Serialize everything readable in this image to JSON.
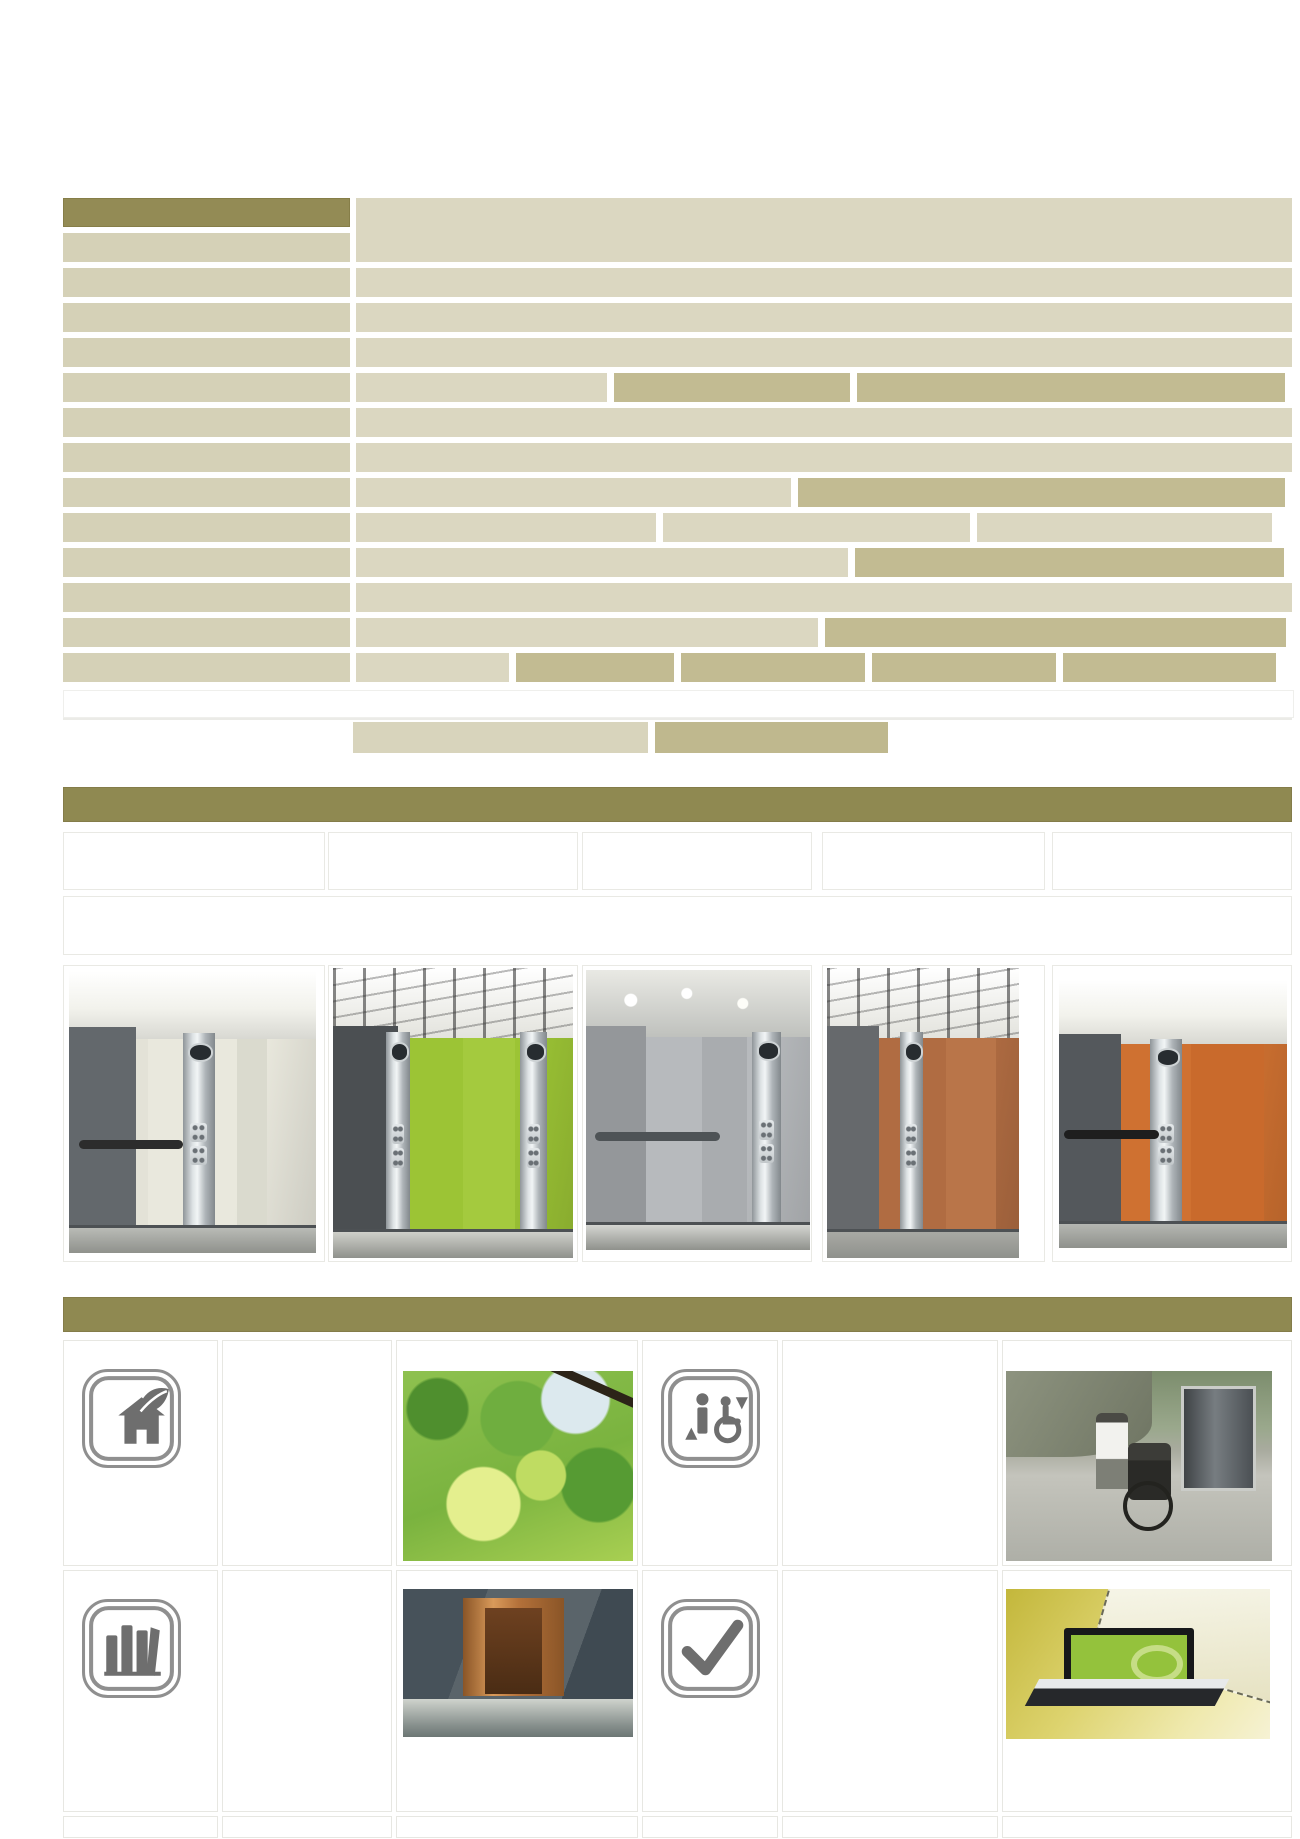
{
  "document": {
    "kind": "elevator brochure page",
    "visible_text": "",
    "note_all_cells_blank": true
  },
  "palette": {
    "olive_header": "#938b55",
    "olive_bar": "#8f8951",
    "beige_light": "#dbd7c1",
    "beige_label": "#d5d1b7",
    "khaki_dark": "#c2bb92",
    "footnote_light": "#d8d4bc",
    "footnote_dark": "#bfb88e",
    "page_bg": "#ffffff"
  },
  "spec_table": {
    "x": 63,
    "y": 198,
    "label_w": 287,
    "content_x": 293,
    "content_w": 936,
    "row_h": 29,
    "row_pitch": 35,
    "rows": [
      {
        "label": "header",
        "right": {
          "merged_rows": 2,
          "cells": [
            [
              "light",
              1.0
            ]
          ]
        }
      },
      {
        "label": "normal",
        "right": null
      },
      {
        "label": "normal",
        "right": {
          "cells": [
            [
              "light",
              1.0
            ]
          ]
        }
      },
      {
        "label": "normal",
        "right": {
          "cells": [
            [
              "light",
              1.0
            ]
          ]
        }
      },
      {
        "label": "normal",
        "right": {
          "cells": [
            [
              "light",
              1.0
            ]
          ]
        }
      },
      {
        "label": "normal",
        "right": {
          "cells": [
            [
              "light",
              0.268
            ],
            [
              "dark",
              0.252
            ],
            [
              "dark",
              0.458
            ]
          ]
        }
      },
      {
        "label": "normal",
        "right": {
          "cells": [
            [
              "light",
              1.0
            ]
          ]
        }
      },
      {
        "label": "normal",
        "right": {
          "cells": [
            [
              "light",
              1.0
            ]
          ]
        }
      },
      {
        "label": "normal",
        "right": {
          "cells": [
            [
              "light",
              0.465
            ],
            [
              "dark",
              0.52
            ]
          ]
        }
      },
      {
        "label": "normal",
        "right": {
          "cells": [
            [
              "light",
              0.32
            ],
            [
              "light",
              0.328
            ],
            [
              "light",
              0.316
            ]
          ]
        }
      },
      {
        "label": "normal",
        "right": {
          "cells": [
            [
              "light",
              0.526
            ],
            [
              "dark",
              0.458
            ]
          ]
        }
      },
      {
        "label": "normal",
        "right": {
          "cells": [
            [
              "light",
              1.0
            ]
          ]
        }
      },
      {
        "label": "normal",
        "right": {
          "cells": [
            [
              "light",
              0.494
            ],
            [
              "dark",
              0.492
            ]
          ]
        }
      },
      {
        "label": "normal",
        "right": {
          "cells": [
            [
              "light",
              0.163
            ],
            [
              "dark",
              0.169
            ],
            [
              "dark",
              0.197
            ],
            [
              "dark",
              0.196
            ],
            [
              "dark",
              0.228
            ]
          ]
        }
      }
    ]
  },
  "empty_row": {
    "y": 690,
    "h": 26
  },
  "hairline": {
    "y": 718
  },
  "footnote_row": {
    "y": 722,
    "h": 31,
    "cells": [
      {
        "x": 290,
        "w": 295,
        "tone": "light"
      },
      {
        "x": 592,
        "w": 233,
        "tone": "dark"
      }
    ]
  },
  "gallery": {
    "bar": {
      "y": 787,
      "h": 35
    },
    "header_row": {
      "y": 832,
      "h": 58
    },
    "empty_row": {
      "y": 896,
      "h": 59
    },
    "image_row": {
      "y": 965,
      "h": 297
    },
    "cols": [
      {
        "x": 0,
        "w": 262
      },
      {
        "x": 265,
        "w": 250
      },
      {
        "x": 519,
        "w": 230
      },
      {
        "x": 759,
        "w": 223
      },
      {
        "x": 989,
        "w": 240
      }
    ],
    "cabs": [
      {
        "name": "ivory-cab",
        "img": {
          "l": 5,
          "t": 5,
          "w": 247,
          "h": 282
        },
        "side": "#63686c",
        "wall": "#e9e8dd",
        "ceiling": "plain",
        "floor": "#b9bbb6",
        "panels": [
          [
            "0",
            "32",
            "#e3e2d7"
          ],
          [
            "68",
            "12",
            "#dadace"
          ]
        ],
        "steel": [
          [
            "46",
            "13"
          ]
        ],
        "rail": [
          "#2c2c2c",
          "4",
          "42",
          "60"
        ]
      },
      {
        "name": "green-cab",
        "img": {
          "l": 4,
          "t": 2,
          "w": 240,
          "h": 290
        },
        "side": "#4b4f52",
        "wall": "#9cc435",
        "ceiling": "grid",
        "floor": "#cfd0ca",
        "panels": [
          [
            "0",
            "18",
            "#aed14a"
          ],
          [
            "54",
            "22",
            "#a4ca3e"
          ]
        ],
        "steel": [
          [
            "22",
            "10"
          ],
          [
            "78",
            "11"
          ]
        ],
        "rail": null
      },
      {
        "name": "silver-cab",
        "img": {
          "l": 3,
          "t": 4,
          "w": 224,
          "h": 280
        },
        "side": "#94979a",
        "wall": "#b7babd",
        "ceiling": "spots",
        "floor": "#d4d5d1",
        "panels": [
          [
            "52",
            "20",
            "#a9acaf"
          ]
        ],
        "steel": [
          [
            "74",
            "13"
          ]
        ],
        "rail": [
          "#4e5356",
          "4",
          "56",
          "58"
        ]
      },
      {
        "name": "wood-cab",
        "img": {
          "l": 4,
          "t": 2,
          "w": 192,
          "h": 290
        },
        "side": "#66696c",
        "wall": "#b06c42",
        "ceiling": "grid",
        "floor": "#a8a9a4",
        "panels": [
          [
            "0",
            "26",
            "#a45f38"
          ],
          [
            "62",
            "26",
            "#b97549"
          ]
        ],
        "steel": [
          [
            "38",
            "12"
          ]
        ],
        "rail": null
      },
      {
        "name": "orange-cab",
        "img": {
          "l": 6,
          "t": 14,
          "w": 228,
          "h": 268
        },
        "side": "#54585c",
        "wall": "#cf7131",
        "ceiling": "plain",
        "floor": "#b5b7b2",
        "panels": [
          [
            "58",
            "32",
            "#c96a2c"
          ]
        ],
        "steel": [
          [
            "40",
            "14"
          ]
        ],
        "rail": [
          "#1e1e1e",
          "2",
          "42",
          "56"
        ]
      }
    ]
  },
  "features": {
    "bar": {
      "y": 1297,
      "h": 35
    },
    "grid_y": 1340,
    "cols": [
      {
        "x": 0,
        "w": 155
      },
      {
        "x": 159,
        "w": 170
      },
      {
        "x": 333,
        "w": 242
      },
      {
        "x": 579,
        "w": 136
      },
      {
        "x": 719,
        "w": 216
      },
      {
        "x": 939,
        "w": 290
      }
    ],
    "rows": [
      {
        "y": 0,
        "h": 226,
        "cells": [
          {
            "icon": "eco-house-icon"
          },
          {},
          {
            "photo": "leaves",
            "l": 6,
            "t": 30,
            "w": 230,
            "h": 190
          },
          {
            "icon": "elevator-accessibility-icon"
          },
          {},
          {
            "photo": "outdoor-wheelchair",
            "l": 3,
            "t": 30,
            "w": 266,
            "h": 190
          }
        ]
      },
      {
        "y": 230,
        "h": 242,
        "cells": [
          {
            "icon": "stacked-books-icon"
          },
          {},
          {
            "photo": "copper-lobby",
            "l": 6,
            "t": 18,
            "w": 230,
            "h": 148
          },
          {
            "icon": "checkmark-icon"
          },
          {},
          {
            "photo": "laptop-panel",
            "l": 3,
            "t": 18,
            "w": 264,
            "h": 150
          }
        ]
      },
      {
        "y": 476,
        "h": 22,
        "cells": [
          {},
          {},
          {},
          {},
          {},
          {}
        ]
      }
    ]
  }
}
